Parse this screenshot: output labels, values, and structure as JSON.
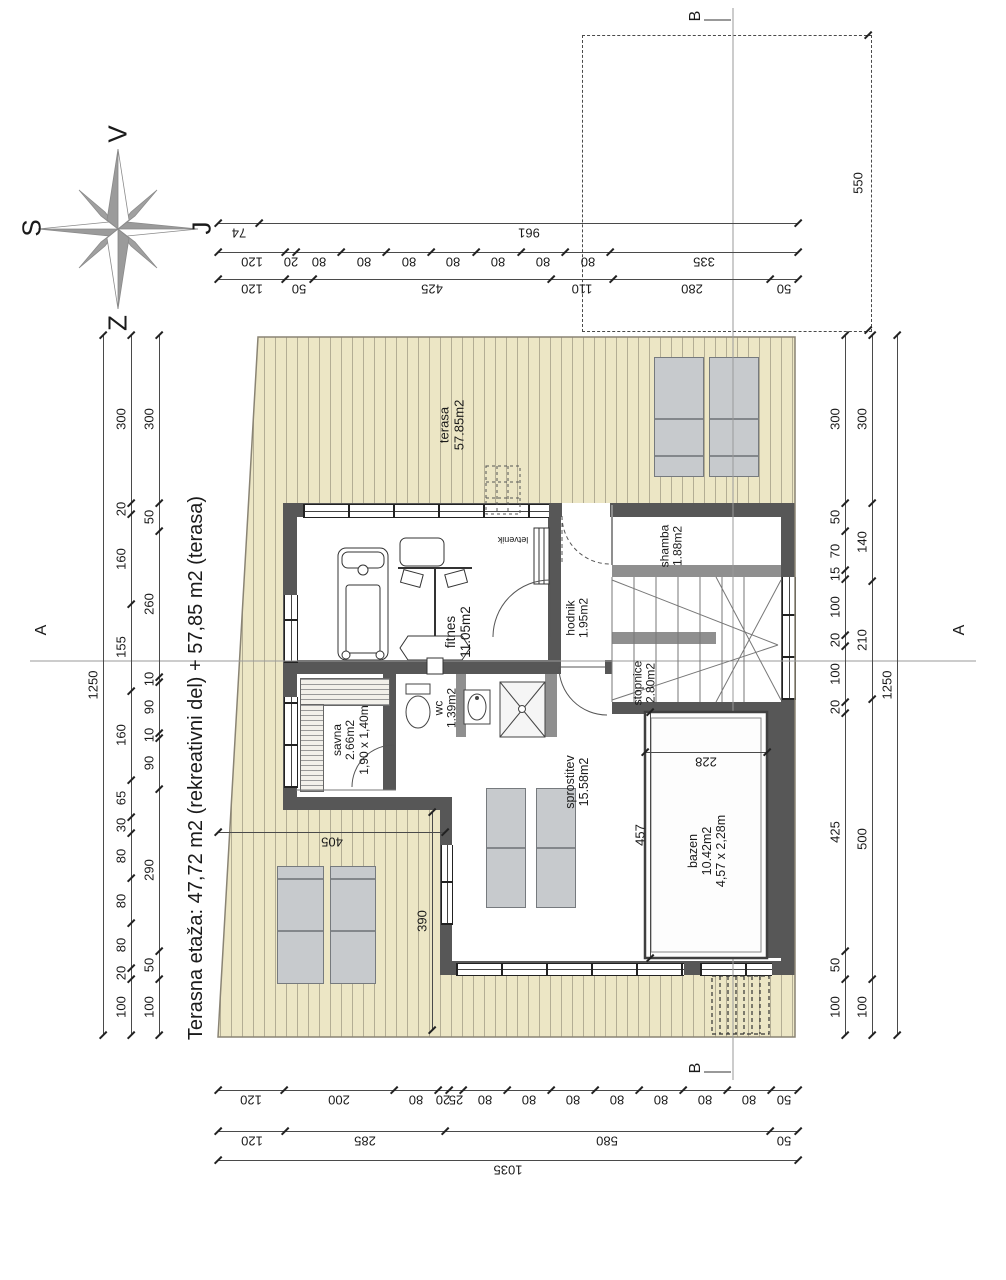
{
  "title": "Terasna etaža: 47,72 m2 (rekreativni del) + 57,85 m2 (terasa)",
  "colors": {
    "wall": "#575757",
    "wall_light": "#8f8f8f",
    "deck": "#ece6c5",
    "deck_stripe": "#b3ad94",
    "lounger": "#c7cacd",
    "dim_line": "#4a4a4a"
  },
  "compass": {
    "top": "V",
    "left": "S",
    "right": "J",
    "bottom": "Z"
  },
  "sections": {
    "a": "A",
    "b": "B"
  },
  "labels": [
    {
      "id": "label-terasa",
      "x": 452,
      "y": 425,
      "rot": -90,
      "size": 13,
      "lines": [
        "terasa",
        "57.85m2"
      ]
    },
    {
      "id": "label-fitnes",
      "x": 458,
      "y": 632,
      "rot": -90,
      "size": 13.5,
      "lines": [
        "fitnes",
        "11.05m2"
      ]
    },
    {
      "id": "label-hodnik",
      "x": 578,
      "y": 618,
      "rot": -90,
      "size": 12,
      "lines": [
        "hodnik",
        "1.95m2"
      ]
    },
    {
      "id": "label-shamba",
      "x": 672,
      "y": 546,
      "rot": -90,
      "size": 12,
      "lines": [
        "shamba",
        "1.88m2"
      ]
    },
    {
      "id": "label-stopnice",
      "x": 645,
      "y": 683,
      "rot": -90,
      "size": 12,
      "lines": [
        "stopnice",
        "2.80m2"
      ]
    },
    {
      "id": "label-savna",
      "x": 351,
      "y": 740,
      "rot": -90,
      "size": 12,
      "lines": [
        "savna",
        "2.66m2",
        "1,90 x 1,40m"
      ]
    },
    {
      "id": "label-wc",
      "x": 446,
      "y": 708,
      "rot": -90,
      "size": 12,
      "lines": [
        "wc",
        "1.39m2"
      ]
    },
    {
      "id": "label-sprostitev",
      "x": 577,
      "y": 782,
      "rot": -90,
      "size": 12.5,
      "lines": [
        "sprostitev",
        "15.58m2"
      ]
    },
    {
      "id": "label-bazen",
      "x": 707,
      "y": 851,
      "rot": -90,
      "size": 12.5,
      "lines": [
        "bazen",
        "10.42m2",
        "4,57 x 2,28m"
      ]
    },
    {
      "id": "label-letvenik",
      "x": 513,
      "y": 540,
      "rot": 180,
      "size": 9,
      "lines": [
        "letvenik"
      ]
    },
    {
      "id": "section-a-left",
      "x": 42,
      "y": 630,
      "rot": -90,
      "size": 16,
      "lines": [
        "A"
      ]
    },
    {
      "id": "section-a-right",
      "x": 960,
      "y": 630,
      "rot": -90,
      "size": 16,
      "lines": [
        "A"
      ]
    },
    {
      "id": "section-b-top",
      "x": 696,
      "y": 16,
      "rot": -90,
      "size": 16,
      "lines": [
        "B"
      ]
    },
    {
      "id": "section-b-bottom",
      "x": 696,
      "y": 1068,
      "rot": -90,
      "size": 16,
      "lines": [
        "B"
      ]
    },
    {
      "id": "compass-v",
      "x": 118,
      "y": 134,
      "rot": -90,
      "size": 26,
      "lines": [
        "V"
      ]
    },
    {
      "id": "compass-s",
      "x": 32,
      "y": 228,
      "rot": -90,
      "size": 26,
      "lines": [
        "S"
      ]
    },
    {
      "id": "compass-j",
      "x": 202,
      "y": 228,
      "rot": -90,
      "size": 26,
      "lines": [
        "J"
      ]
    },
    {
      "id": "compass-z",
      "x": 118,
      "y": 323,
      "rot": -90,
      "size": 26,
      "lines": [
        "Z"
      ]
    },
    {
      "id": "plan-title",
      "x": 196,
      "y": 768,
      "rot": -90,
      "size": 20,
      "lines": [
        "Terasna etaža: 47,72 m2 (rekreativni del) + 57,85 m2 (terasa)"
      ]
    }
  ],
  "dimension_chains": [
    {
      "id": "dim-top-row1",
      "o": "h",
      "x0": 218,
      "x1": 798,
      "y": 223,
      "values": [
        74,
        961
      ]
    },
    {
      "id": "dim-top-row2",
      "o": "h",
      "x0": 218,
      "x1": 798,
      "y": 252,
      "values": [
        120,
        20,
        80,
        80,
        80,
        80,
        80,
        80,
        80,
        335
      ]
    },
    {
      "id": "dim-top-row3",
      "o": "h",
      "x0": 218,
      "x1": 798,
      "y": 279,
      "values": [
        120,
        50,
        425,
        110,
        280,
        50
      ]
    },
    {
      "id": "dim-plot-550",
      "o": "v",
      "x": 868,
      "y0": 35,
      "y1": 330,
      "values": [
        550
      ],
      "noline": true
    },
    {
      "id": "dim-left-total",
      "o": "v",
      "x": 103,
      "y0": 335,
      "y1": 1035,
      "values": [
        1250
      ]
    },
    {
      "id": "dim-left-mid",
      "o": "v",
      "x": 131,
      "y0": 335,
      "y1": 1035,
      "values": [
        300,
        20,
        160,
        155,
        160,
        65,
        30,
        80,
        80,
        80,
        20,
        100
      ]
    },
    {
      "id": "dim-left-inner",
      "o": "v",
      "x": 159,
      "y0": 335,
      "y1": 1035,
      "values": [
        300,
        50,
        260,
        10,
        90,
        10,
        90,
        290,
        50,
        100
      ]
    },
    {
      "id": "dim-right-inner",
      "o": "v",
      "x": 845,
      "y0": 335,
      "y1": 1035,
      "values": [
        300,
        50,
        70,
        15,
        100,
        20,
        100,
        20,
        425,
        50,
        100
      ]
    },
    {
      "id": "dim-right-mid",
      "o": "v",
      "x": 872,
      "y0": 335,
      "y1": 1035,
      "values": [
        300,
        140,
        210,
        500,
        100
      ]
    },
    {
      "id": "dim-right-total",
      "o": "v",
      "x": 897,
      "y0": 335,
      "y1": 1035,
      "values": [
        1250
      ]
    },
    {
      "id": "dim-bottom-row1",
      "o": "h",
      "x0": 218,
      "x1": 798,
      "y": 1090,
      "values": [
        120,
        200,
        80,
        20,
        25,
        80,
        80,
        80,
        80,
        80,
        80,
        80,
        50
      ]
    },
    {
      "id": "dim-bottom-row2",
      "o": "h",
      "x0": 218,
      "x1": 798,
      "y": 1131,
      "values": [
        120,
        285,
        580,
        50
      ]
    },
    {
      "id": "dim-bottom-row3",
      "o": "h",
      "x0": 218,
      "x1": 798,
      "y": 1160,
      "values": [
        1035
      ]
    },
    {
      "id": "dim-terrace-405",
      "o": "h",
      "x0": 218,
      "x1": 445,
      "y": 832,
      "values": [
        405
      ]
    },
    {
      "id": "dim-terrace-390",
      "o": "v",
      "x": 432,
      "y0": 812,
      "y1": 1030,
      "values": [
        390
      ]
    },
    {
      "id": "dim-pool-228",
      "o": "h",
      "x0": 645,
      "x1": 767,
      "y": 752,
      "values": [
        228
      ]
    },
    {
      "id": "dim-pool-457",
      "o": "v",
      "x": 650,
      "y0": 712,
      "y1": 958,
      "values": [
        457
      ]
    }
  ]
}
